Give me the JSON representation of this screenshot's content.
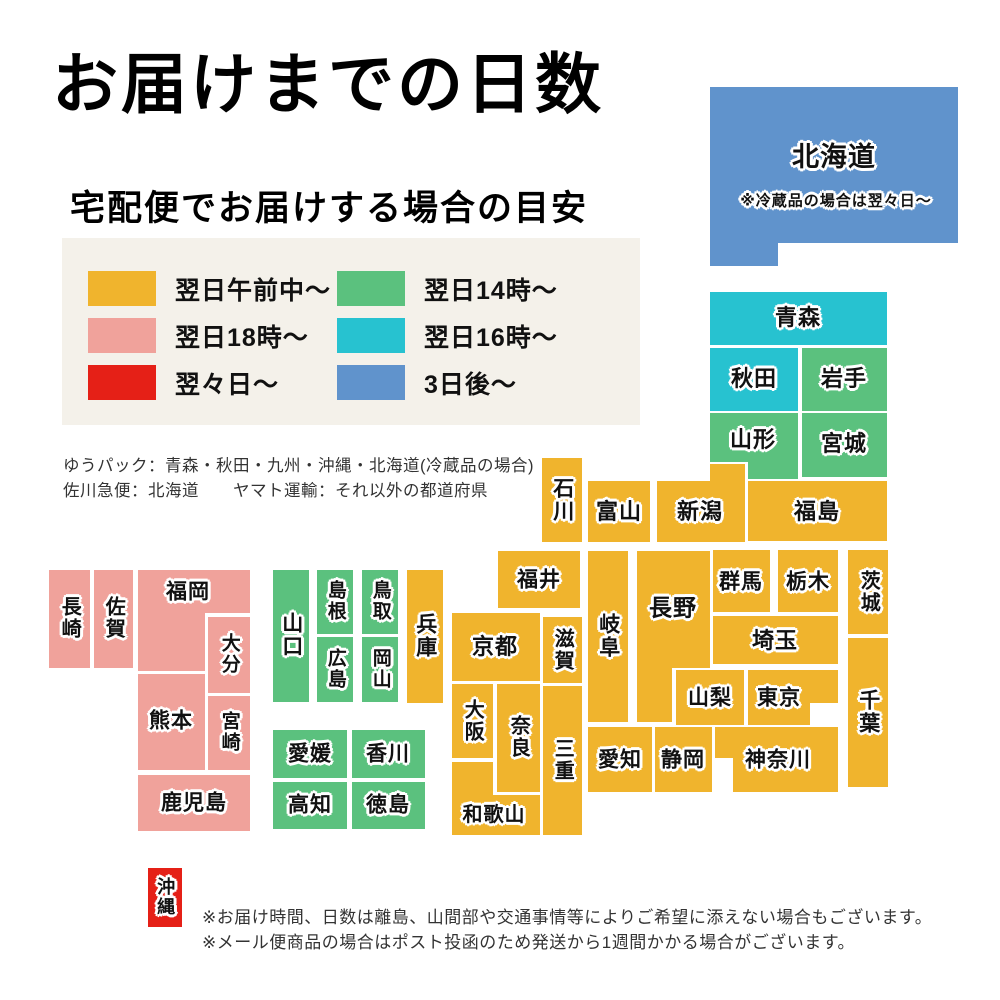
{
  "title": "お届けまでの日数",
  "subtitle": "宅配便でお届けする場合の目安",
  "palette": {
    "morning": "#F0B42D",
    "eve18": "#F0A29B",
    "twoDays": "#E52017",
    "day14": "#5BC17E",
    "day16": "#27C2D0",
    "threeDays": "#6093CC",
    "legend_bg": "#f4f1ea"
  },
  "legend": {
    "items": [
      {
        "label": "翌日午前中〜",
        "color": "morning"
      },
      {
        "label": "翌日18時〜",
        "color": "eve18"
      },
      {
        "label": "翌々日〜",
        "color": "twoDays"
      },
      {
        "label": "翌日14時〜",
        "color": "day14"
      },
      {
        "label": "翌日16時〜",
        "color": "day16"
      },
      {
        "label": "3日後〜",
        "color": "threeDays"
      }
    ]
  },
  "carrier_notes": [
    "ゆうパック：青森・秋田・九州・沖縄・北海道(冷蔵品の場合)",
    "佐川急便：北海道　　ヤマト運輸：それ以外の都道府県"
  ],
  "footnotes": [
    "※お届け時間、日数は離島、山間部や交通事情等によりご希望に添えない場合もございます。",
    "※メール便商品の場合はポスト投函のため発送から1週間かかる場合がございます。"
  ],
  "map": {
    "prefectures": [
      {
        "name": "北海道",
        "color": "threeDays",
        "rects": [
          [
            710,
            87,
            248,
            156
          ],
          [
            710,
            87,
            68,
            179
          ]
        ],
        "label": {
          "x": 834,
          "y": 158,
          "fs": 27
        },
        "note": {
          "text": "※冷蔵品の場合は翌々日〜",
          "x": 836,
          "y": 201,
          "fs": 15
        }
      },
      {
        "name": "青森",
        "color": "day16",
        "rects": [
          [
            710,
            292,
            177,
            53
          ]
        ],
        "label": {
          "x": 798,
          "y": 318,
          "fs": 22
        }
      },
      {
        "name": "秋田",
        "color": "day16",
        "rects": [
          [
            710,
            348,
            88,
            63
          ]
        ],
        "label": {
          "x": 754,
          "y": 379,
          "fs": 22
        }
      },
      {
        "name": "岩手",
        "color": "day14",
        "rects": [
          [
            802,
            348,
            85,
            63
          ]
        ],
        "label": {
          "x": 844,
          "y": 379,
          "fs": 22
        }
      },
      {
        "name": "山形",
        "color": "day14",
        "rects": [
          [
            710,
            413,
            88,
            49
          ],
          [
            748,
            413,
            50,
            66
          ]
        ],
        "label": {
          "x": 753,
          "y": 440,
          "fs": 22
        }
      },
      {
        "name": "宮城",
        "color": "day14",
        "rects": [
          [
            802,
            413,
            85,
            64
          ]
        ],
        "label": {
          "x": 844,
          "y": 444,
          "fs": 22
        }
      },
      {
        "name": "石川",
        "color": "morning",
        "rects": [
          [
            542,
            458,
            40,
            84
          ]
        ],
        "label": {
          "x": 562,
          "y": 500,
          "fs": 21
        },
        "vertical": true
      },
      {
        "name": "富山",
        "color": "morning",
        "rects": [
          [
            588,
            481,
            62,
            61
          ]
        ],
        "label": {
          "x": 619,
          "y": 512,
          "fs": 22
        }
      },
      {
        "name": "新潟",
        "color": "morning",
        "rects": [
          [
            657,
            481,
            88,
            61
          ],
          [
            710,
            464,
            35,
            20
          ]
        ],
        "label": {
          "x": 700,
          "y": 512,
          "fs": 22
        }
      },
      {
        "name": "福島",
        "color": "morning",
        "rects": [
          [
            748,
            481,
            139,
            60
          ]
        ],
        "label": {
          "x": 817,
          "y": 512,
          "fs": 22
        }
      },
      {
        "name": "福井",
        "color": "morning",
        "rects": [
          [
            498,
            551,
            82,
            57
          ]
        ],
        "label": {
          "x": 539,
          "y": 580,
          "fs": 21
        }
      },
      {
        "name": "岐阜",
        "color": "morning",
        "rects": [
          [
            588,
            551,
            40,
            171
          ]
        ],
        "label": {
          "x": 608,
          "y": 636,
          "fs": 21
        },
        "vertical": true
      },
      {
        "name": "長野",
        "color": "morning",
        "rects": [
          [
            637,
            551,
            73,
            117
          ],
          [
            637,
            551,
            35,
            171
          ]
        ],
        "label": {
          "x": 673,
          "y": 608,
          "fs": 23
        }
      },
      {
        "name": "群馬",
        "color": "morning",
        "rects": [
          [
            713,
            550,
            57,
            62
          ]
        ],
        "label": {
          "x": 741,
          "y": 582,
          "fs": 21
        }
      },
      {
        "name": "栃木",
        "color": "morning",
        "rects": [
          [
            778,
            550,
            60,
            62
          ]
        ],
        "label": {
          "x": 808,
          "y": 582,
          "fs": 21
        }
      },
      {
        "name": "茨城",
        "color": "morning",
        "rects": [
          [
            848,
            550,
            40,
            84
          ]
        ],
        "label": {
          "x": 868,
          "y": 592,
          "fs": 20
        },
        "vertical": true
      },
      {
        "name": "埼玉",
        "color": "morning",
        "rects": [
          [
            713,
            616,
            125,
            48
          ]
        ],
        "label": {
          "x": 775,
          "y": 641,
          "fs": 22
        }
      },
      {
        "name": "千葉",
        "color": "morning",
        "rects": [
          [
            848,
            638,
            40,
            149
          ]
        ],
        "label": {
          "x": 868,
          "y": 712,
          "fs": 21
        },
        "vertical": true
      },
      {
        "name": "山梨",
        "color": "morning",
        "rects": [
          [
            676,
            670,
            68,
            55
          ]
        ],
        "label": {
          "x": 710,
          "y": 698,
          "fs": 21
        }
      },
      {
        "name": "東京",
        "color": "morning",
        "rects": [
          [
            748,
            670,
            90,
            33
          ],
          [
            748,
            670,
            62,
            55
          ]
        ],
        "label": {
          "x": 779,
          "y": 698,
          "fs": 21
        }
      },
      {
        "name": "神奈川",
        "color": "morning",
        "rects": [
          [
            715,
            727,
            123,
            31
          ],
          [
            733,
            727,
            105,
            65
          ]
        ],
        "label": {
          "x": 778,
          "y": 760,
          "fs": 21
        }
      },
      {
        "name": "静岡",
        "color": "morning",
        "rects": [
          [
            655,
            727,
            57,
            65
          ]
        ],
        "label": {
          "x": 683,
          "y": 760,
          "fs": 21
        }
      },
      {
        "name": "愛知",
        "color": "morning",
        "rects": [
          [
            588,
            727,
            64,
            65
          ]
        ],
        "label": {
          "x": 620,
          "y": 760,
          "fs": 21
        }
      },
      {
        "name": "滋賀",
        "color": "morning",
        "rects": [
          [
            543,
            617,
            39,
            66
          ]
        ],
        "label": {
          "x": 562,
          "y": 650,
          "fs": 20
        },
        "vertical": true
      },
      {
        "name": "京都",
        "color": "morning",
        "rects": [
          [
            452,
            613,
            88,
            68
          ]
        ],
        "label": {
          "x": 495,
          "y": 647,
          "fs": 22
        }
      },
      {
        "name": "大阪",
        "color": "morning",
        "rects": [
          [
            452,
            684,
            41,
            74
          ]
        ],
        "label": {
          "x": 472,
          "y": 721,
          "fs": 20
        },
        "vertical": true
      },
      {
        "name": "奈良",
        "color": "morning",
        "rects": [
          [
            497,
            684,
            43,
            108
          ]
        ],
        "label": {
          "x": 518,
          "y": 737,
          "fs": 20
        },
        "vertical": true
      },
      {
        "name": "和歌山",
        "color": "morning",
        "rects": [
          [
            452,
            762,
            41,
            73
          ],
          [
            452,
            795,
            88,
            40
          ]
        ],
        "label": {
          "x": 494,
          "y": 815,
          "fs": 20
        }
      },
      {
        "name": "三重",
        "color": "morning",
        "rects": [
          [
            543,
            686,
            39,
            149
          ]
        ],
        "label": {
          "x": 562,
          "y": 760,
          "fs": 20
        },
        "vertical": true
      },
      {
        "name": "兵庫",
        "color": "morning",
        "rects": [
          [
            407,
            570,
            36,
            133
          ]
        ],
        "label": {
          "x": 425,
          "y": 636,
          "fs": 21
        },
        "vertical": true
      },
      {
        "name": "鳥取",
        "color": "day14",
        "rects": [
          [
            362,
            570,
            36,
            64
          ]
        ],
        "label": {
          "x": 380,
          "y": 601,
          "fs": 19
        },
        "vertical": true
      },
      {
        "name": "島根",
        "color": "day14",
        "rects": [
          [
            317,
            570,
            36,
            64
          ]
        ],
        "label": {
          "x": 335,
          "y": 601,
          "fs": 19
        },
        "vertical": true
      },
      {
        "name": "岡山",
        "color": "day14",
        "rects": [
          [
            362,
            637,
            36,
            65
          ]
        ],
        "label": {
          "x": 380,
          "y": 669,
          "fs": 19
        },
        "vertical": true
      },
      {
        "name": "広島",
        "color": "day14",
        "rects": [
          [
            317,
            637,
            36,
            65
          ]
        ],
        "label": {
          "x": 335,
          "y": 669,
          "fs": 19
        },
        "vertical": true
      },
      {
        "name": "山口",
        "color": "day14",
        "rects": [
          [
            273,
            570,
            36,
            132
          ]
        ],
        "label": {
          "x": 291,
          "y": 635,
          "fs": 21
        },
        "vertical": true
      },
      {
        "name": "愛媛",
        "color": "day14",
        "rects": [
          [
            273,
            730,
            74,
            48
          ]
        ],
        "label": {
          "x": 310,
          "y": 754,
          "fs": 21
        }
      },
      {
        "name": "香川",
        "color": "day14",
        "rects": [
          [
            352,
            730,
            73,
            48
          ]
        ],
        "label": {
          "x": 388,
          "y": 754,
          "fs": 21
        }
      },
      {
        "name": "高知",
        "color": "day14",
        "rects": [
          [
            273,
            782,
            74,
            47
          ]
        ],
        "label": {
          "x": 310,
          "y": 805,
          "fs": 21
        }
      },
      {
        "name": "徳島",
        "color": "day14",
        "rects": [
          [
            352,
            782,
            73,
            47
          ]
        ],
        "label": {
          "x": 388,
          "y": 805,
          "fs": 21
        }
      },
      {
        "name": "福岡",
        "color": "eve18",
        "rects": [
          [
            138,
            570,
            112,
            43
          ],
          [
            138,
            570,
            67,
            101
          ]
        ],
        "label": {
          "x": 188,
          "y": 592,
          "fs": 21
        }
      },
      {
        "name": "佐賀",
        "color": "eve18",
        "rects": [
          [
            94,
            570,
            39,
            98
          ]
        ],
        "label": {
          "x": 113,
          "y": 618,
          "fs": 20
        },
        "vertical": true
      },
      {
        "name": "長崎",
        "color": "eve18",
        "rects": [
          [
            49,
            570,
            41,
            98
          ]
        ],
        "label": {
          "x": 69,
          "y": 618,
          "fs": 20
        },
        "vertical": true
      },
      {
        "name": "大分",
        "color": "eve18",
        "rects": [
          [
            208,
            617,
            42,
            76
          ]
        ],
        "label": {
          "x": 229,
          "y": 654,
          "fs": 19
        },
        "vertical": true
      },
      {
        "name": "熊本",
        "color": "eve18",
        "rects": [
          [
            138,
            674,
            67,
            96
          ]
        ],
        "label": {
          "x": 171,
          "y": 721,
          "fs": 21
        }
      },
      {
        "name": "宮崎",
        "color": "eve18",
        "rects": [
          [
            208,
            696,
            42,
            74
          ]
        ],
        "label": {
          "x": 229,
          "y": 732,
          "fs": 19
        },
        "vertical": true
      },
      {
        "name": "鹿児島",
        "color": "eve18",
        "rects": [
          [
            138,
            775,
            112,
            56
          ]
        ],
        "label": {
          "x": 194,
          "y": 803,
          "fs": 21
        }
      },
      {
        "name": "沖縄",
        "color": "twoDays",
        "rects": [
          [
            148,
            868,
            34,
            59
          ]
        ],
        "label": {
          "x": 165,
          "y": 897,
          "fs": 18
        },
        "vertical": true
      }
    ]
  }
}
